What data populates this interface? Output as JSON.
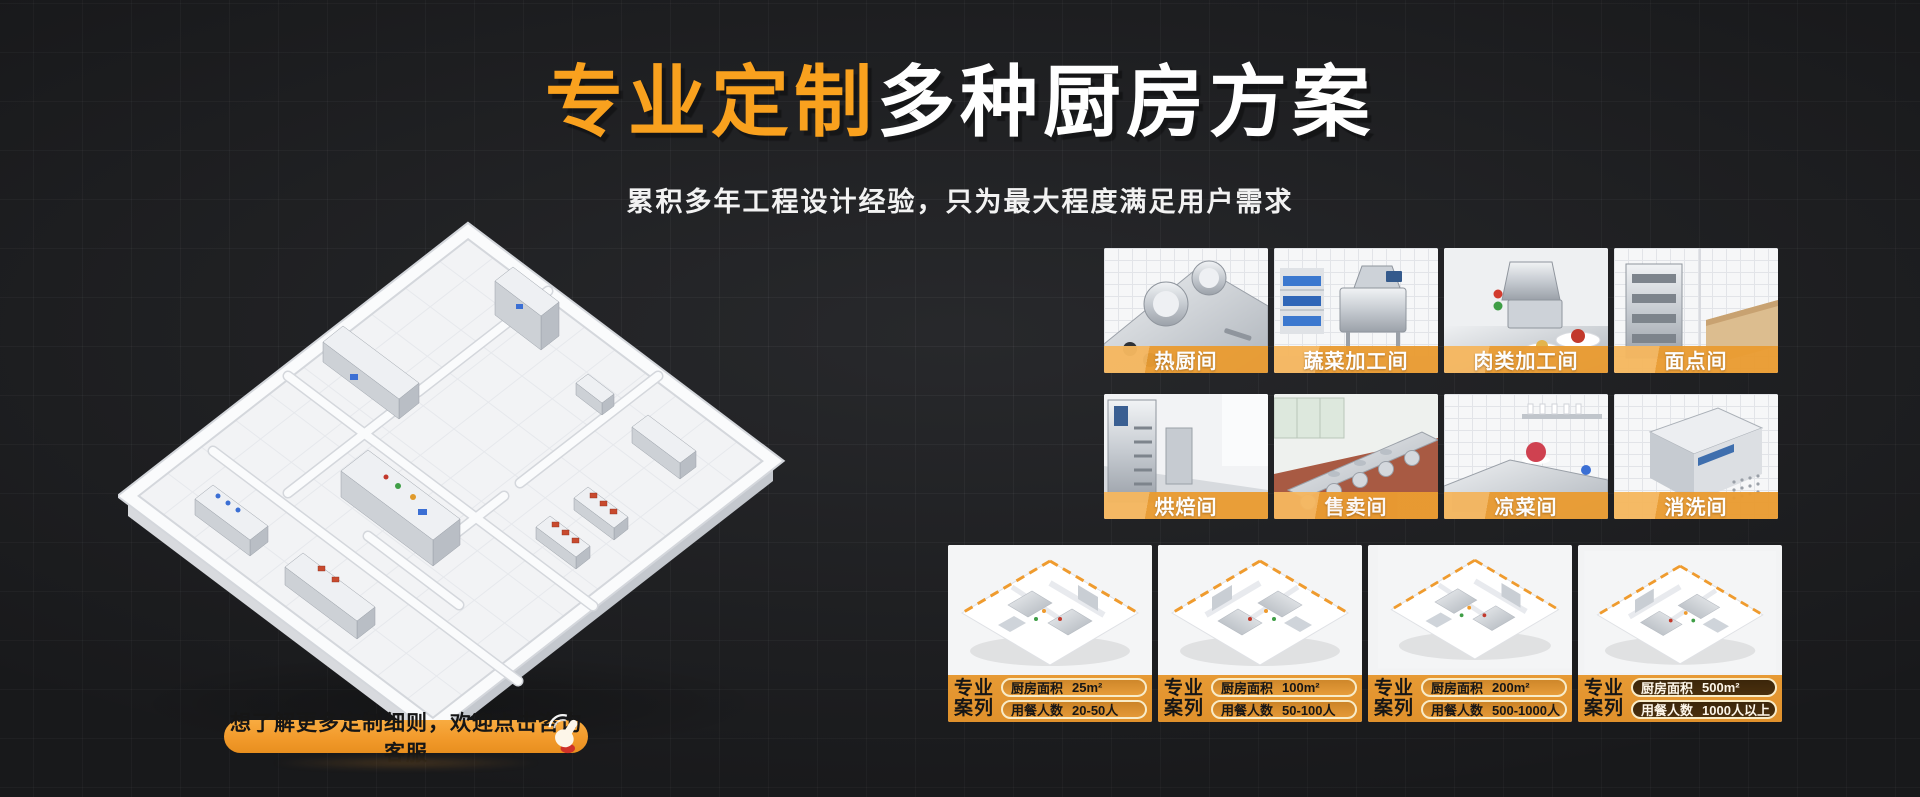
{
  "theme": {
    "bg": "#232427",
    "accent": "#F9A11E",
    "banner": "#EA9C31",
    "banner_light": "#F5B75F",
    "strip": "#E0912C",
    "button_orange": "#F29A2B",
    "pill_border": "#F8ECC9",
    "pill_dark": "#4A300E",
    "text_light": "#FFFFFF",
    "text_dark": "#161616",
    "hand_red": "#CF3128"
  },
  "header": {
    "title_highlight": "专业定制",
    "title_rest": "多种厨房方案",
    "subtitle": "累积多年工程设计经验，只为最大程度满足用户需求"
  },
  "cta": {
    "label": "想了解更多定制细则，欢迎点击咨询客服",
    "icon": "click-hand-icon"
  },
  "gallery": {
    "items": [
      {
        "label": "热厨间"
      },
      {
        "label": "蔬菜加工间"
      },
      {
        "label": "肉类加工间"
      },
      {
        "label": "面点间"
      },
      {
        "label": "烘焙间"
      },
      {
        "label": "售卖间"
      },
      {
        "label": "凉菜间"
      },
      {
        "label": "消洗间"
      }
    ]
  },
  "cases": {
    "badge_line1": "专业",
    "badge_line2": "案列",
    "area_label": "厨房面积",
    "diners_label": "用餐人数",
    "items": [
      {
        "area": "25m²",
        "diners": "20-50人"
      },
      {
        "area": "100m²",
        "diners": "50-100人"
      },
      {
        "area": "200m²",
        "diners": "500-1000人"
      },
      {
        "area": "500m²",
        "diners": "1000人以上"
      }
    ]
  }
}
